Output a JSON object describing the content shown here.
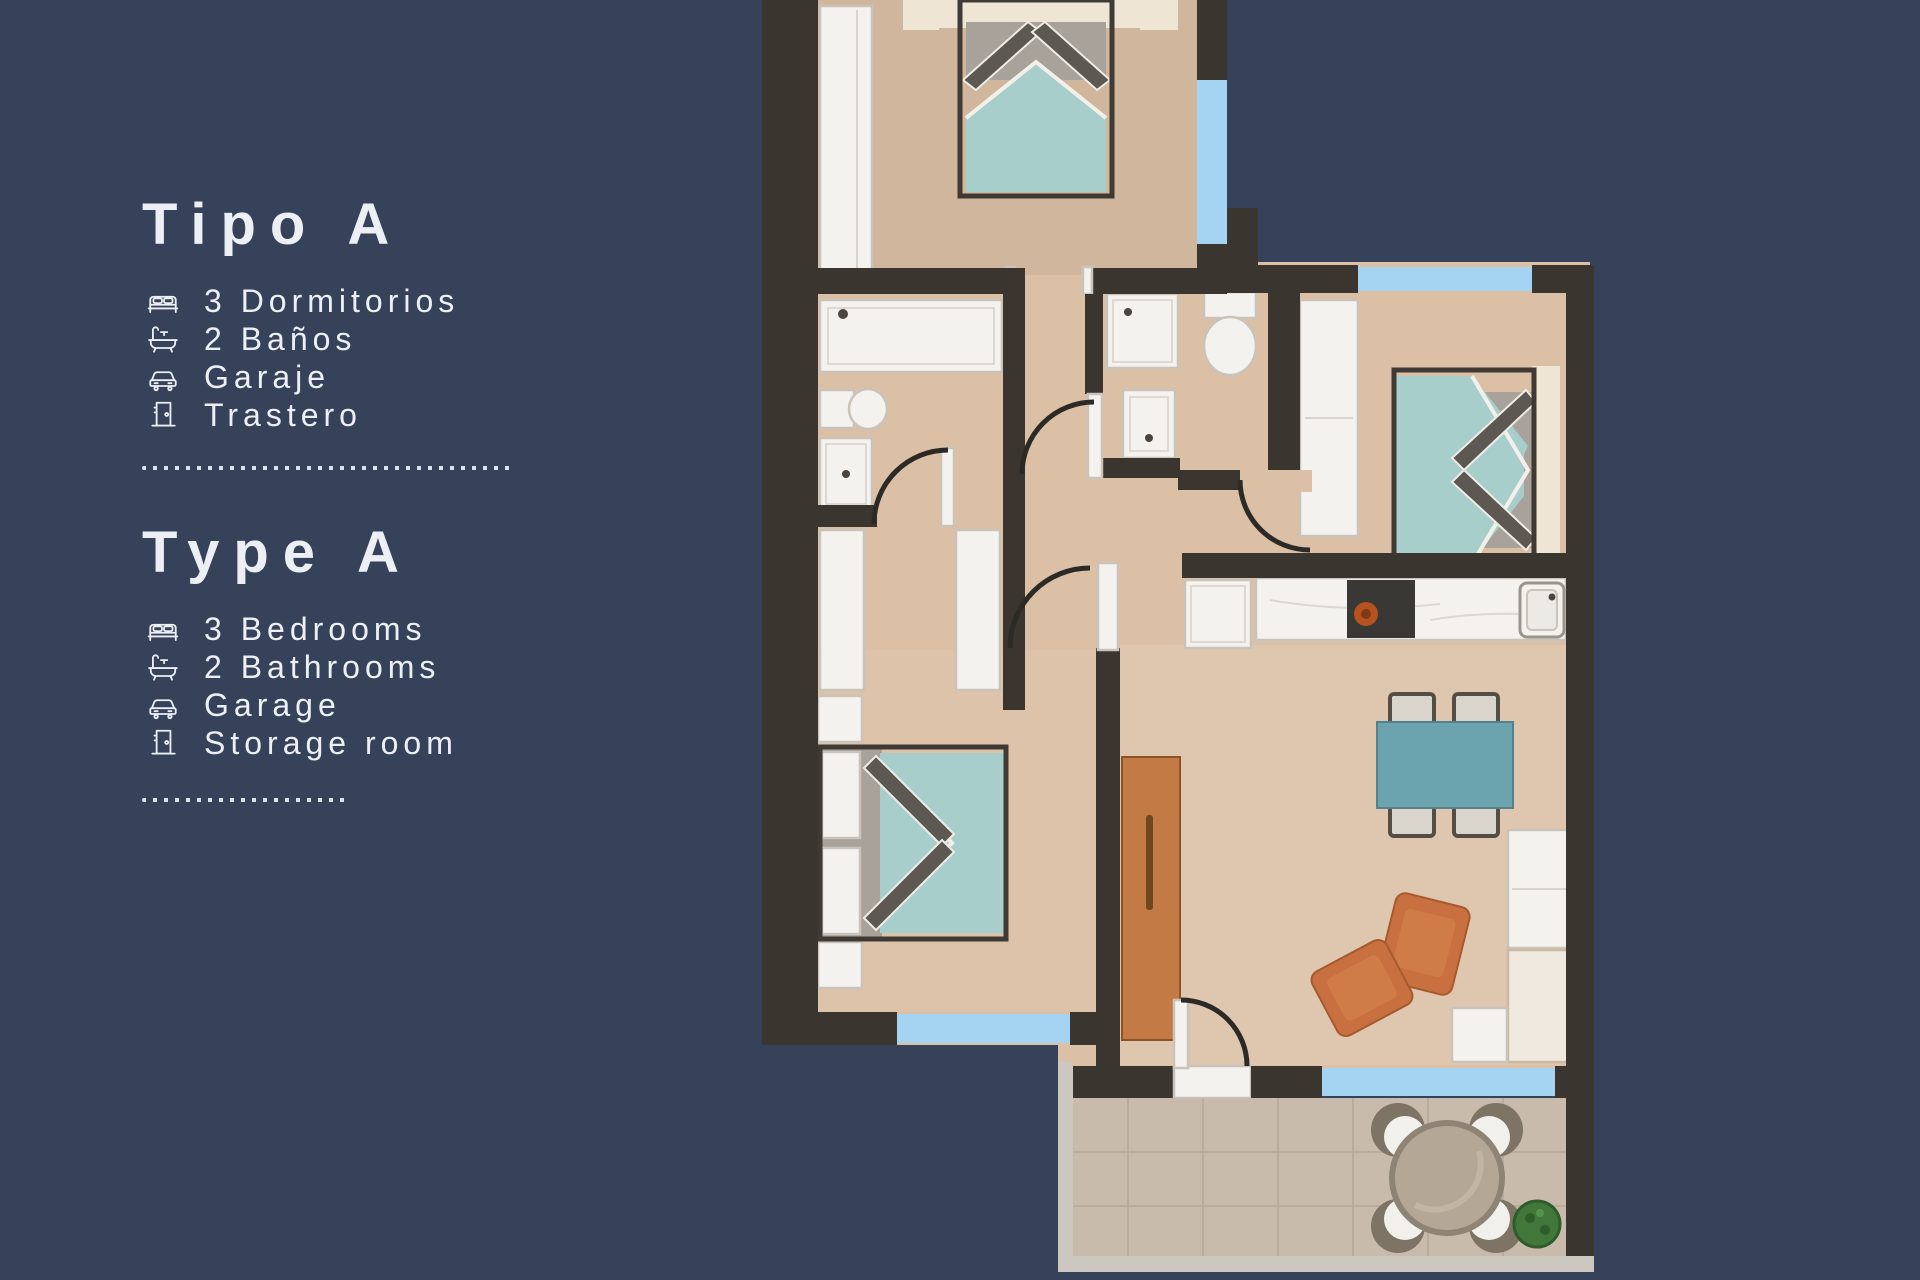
{
  "palette": {
    "background": "#36415a",
    "text": "#ecf0f5",
    "wall": "#3a352f",
    "floor": "#dcc0a6",
    "window": "#a5d3f2",
    "white": "#f4f2ee",
    "trim": "#c9c3ba",
    "bed": "#a8cecb",
    "headboard": "#efe5d4",
    "pillow_dark": "#5d5852",
    "table": "#6ba3ae",
    "wood": "#c47a45",
    "armchair": "#c87040",
    "appliance": "#3a3835",
    "burner": "#b5521f",
    "terrace": "#c9bbab",
    "tile_line": "#b7a795",
    "terrace_table": "#b5a795",
    "plant": "#41773b",
    "arc": "#2c2a26"
  },
  "legend": {
    "sections": [
      {
        "id": "es",
        "title": "Tipo A",
        "items": [
          {
            "icon": "bed-icon",
            "label": "3 Dormitorios"
          },
          {
            "icon": "bath-icon",
            "label": "2 Baños"
          },
          {
            "icon": "car-icon",
            "label": "Garaje"
          },
          {
            "icon": "door-icon",
            "label": "Trastero"
          }
        ]
      },
      {
        "id": "en",
        "title": "Type A",
        "items": [
          {
            "icon": "bed-icon",
            "label": "3 Bedrooms"
          },
          {
            "icon": "bath-icon",
            "label": "2 Bathrooms"
          },
          {
            "icon": "car-icon",
            "label": "Garage"
          },
          {
            "icon": "door-icon",
            "label": "Storage room"
          }
        ]
      }
    ]
  }
}
